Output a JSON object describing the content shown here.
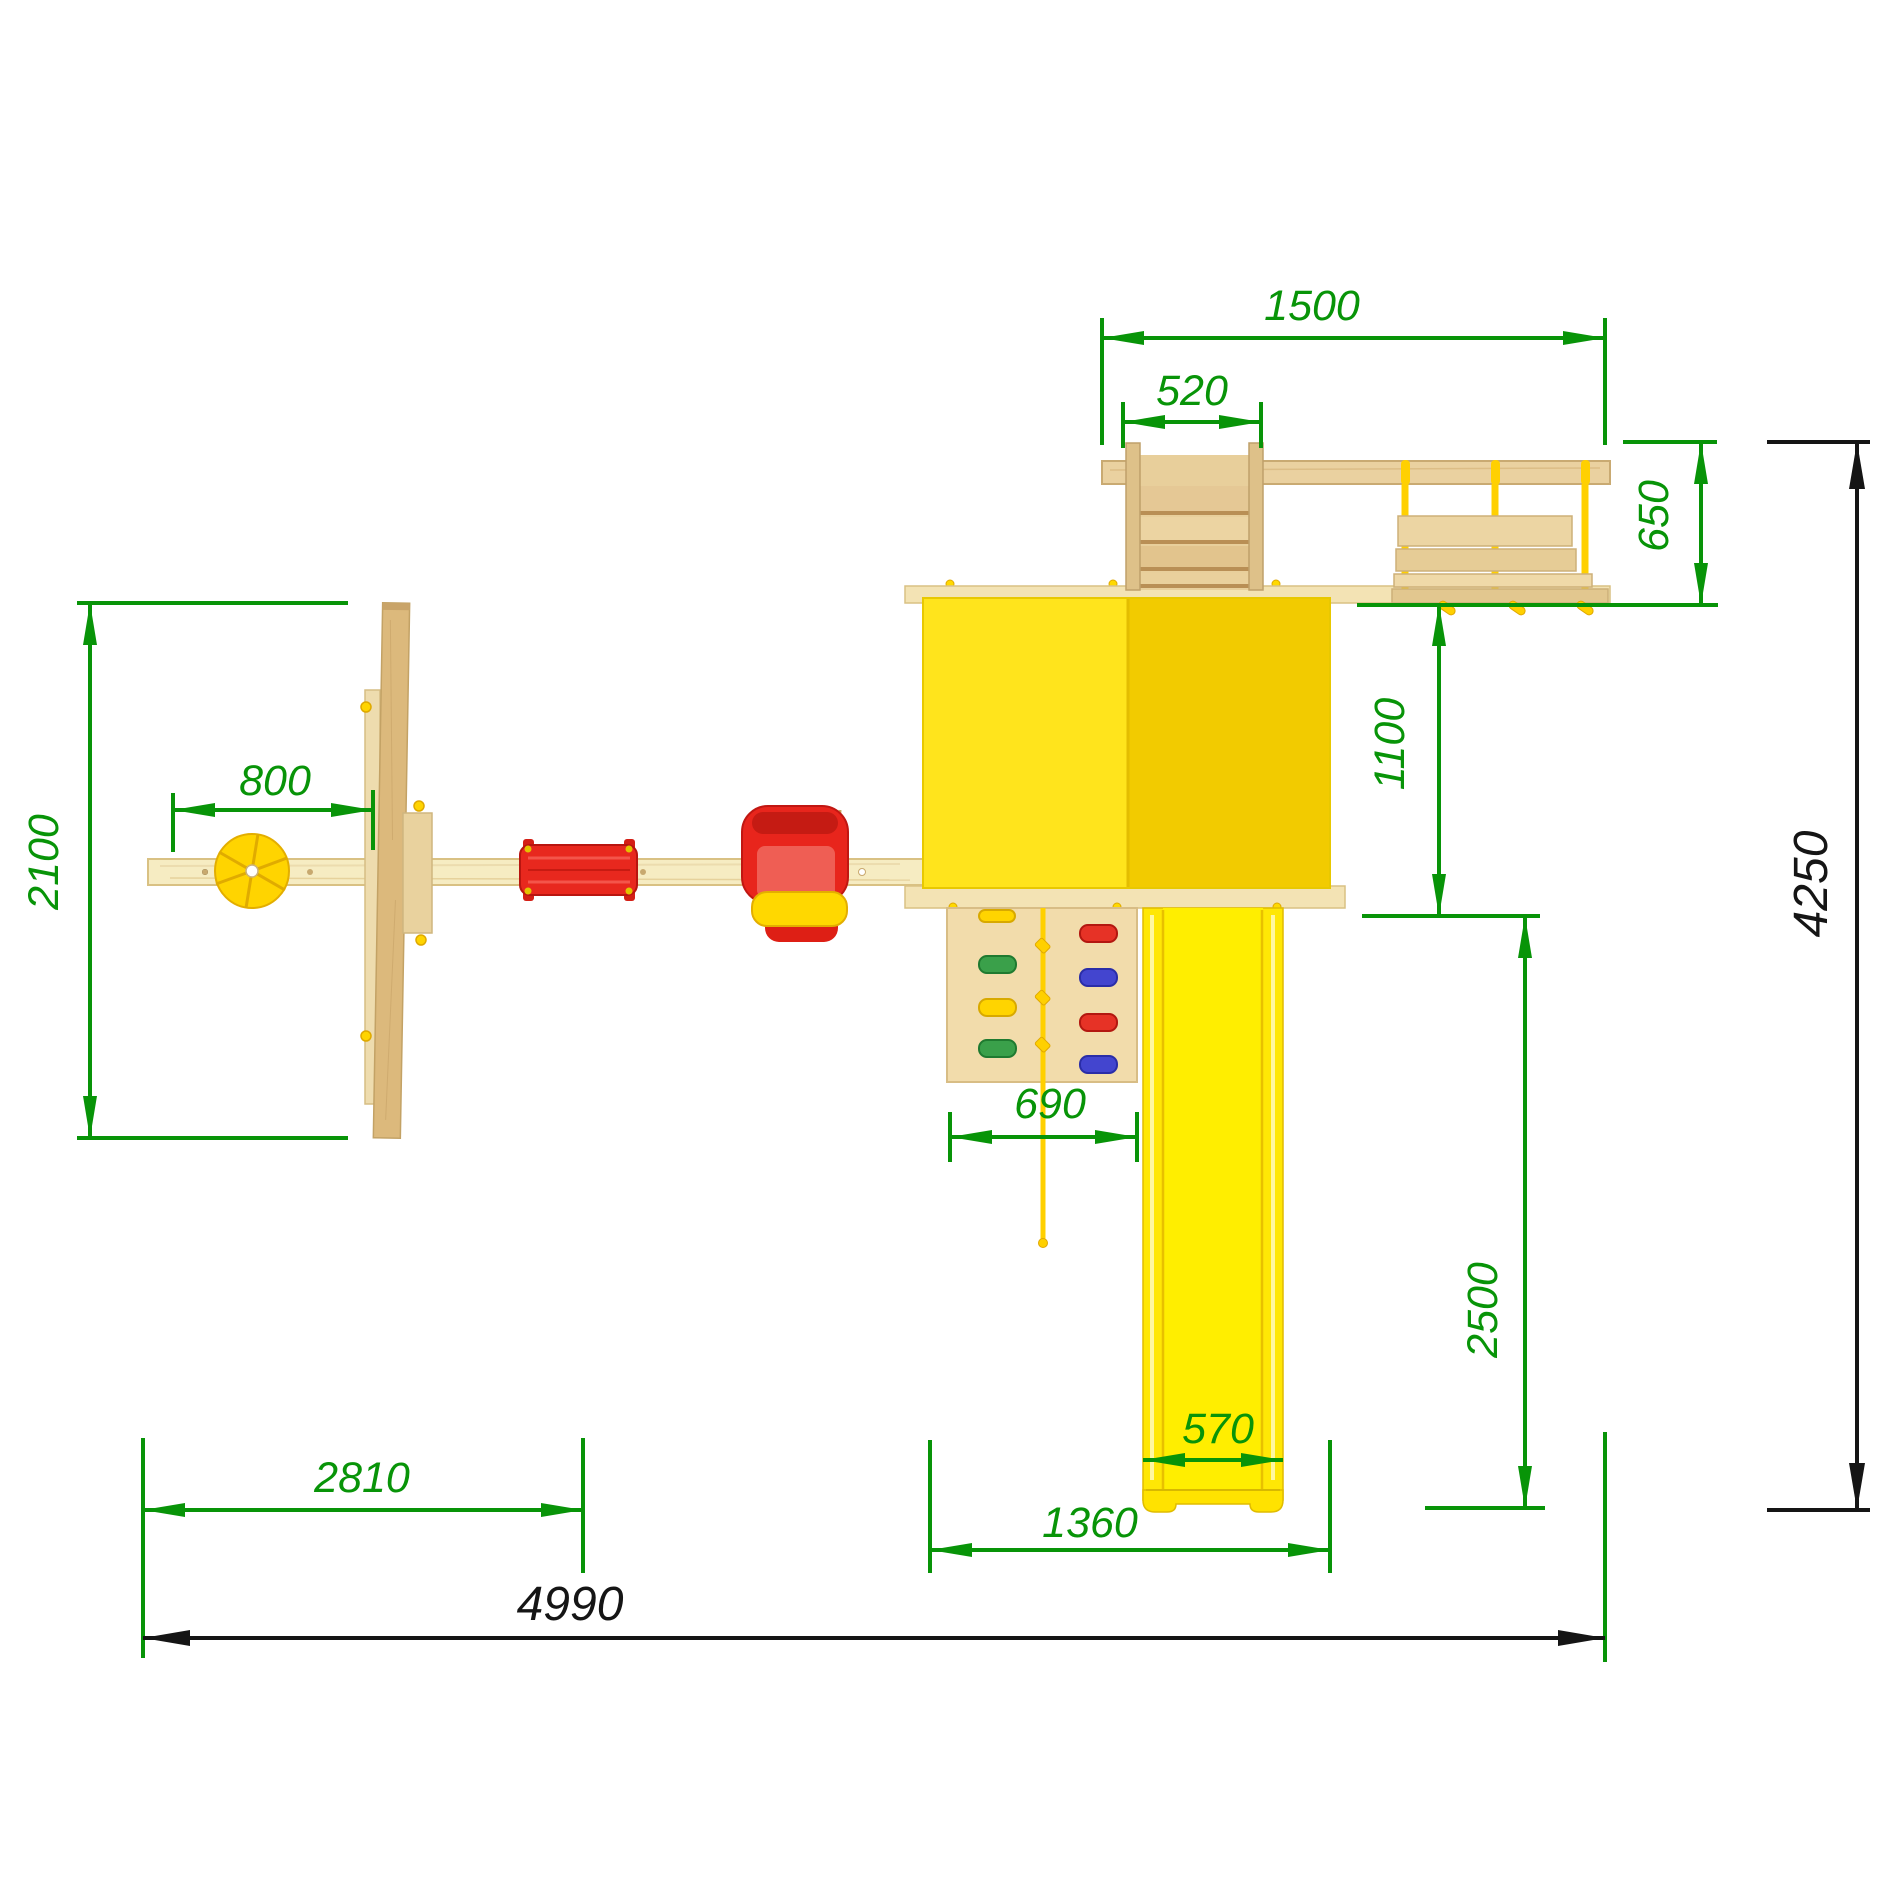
{
  "drawing": {
    "type": "playground-set-top-view-dimension-drawing",
    "units_note": "mm"
  },
  "dimensions": {
    "top_span": "1500",
    "ladder_width": "520",
    "bridge_depth": "650",
    "tower_side": "1100",
    "swing_depth": "2100",
    "swing_offset": "800",
    "climb_width": "690",
    "slide_run": "2500",
    "slide_width": "570",
    "swing_beam_span": "2810",
    "tower_footprint": "1360",
    "total_width": "4990",
    "total_depth": "4250"
  },
  "colors": {
    "dimension_green": "#089408",
    "dimension_black": "#151515",
    "roof_yellow_left": "#ffe41c",
    "roof_yellow_right": "#f2cb00",
    "slide_yellow": "#ffe705",
    "accessory_yellow": "#ffd400",
    "wood_light": "#f6ecc2",
    "wood_mid": "#e8cf9b",
    "wood_dark": "#d9b577",
    "seat_red": "#e6251b",
    "hold_green": "#3aa04a",
    "hold_blue": "#4345cf",
    "hold_red": "#e63226",
    "hold_yellow": "#ffd400"
  }
}
